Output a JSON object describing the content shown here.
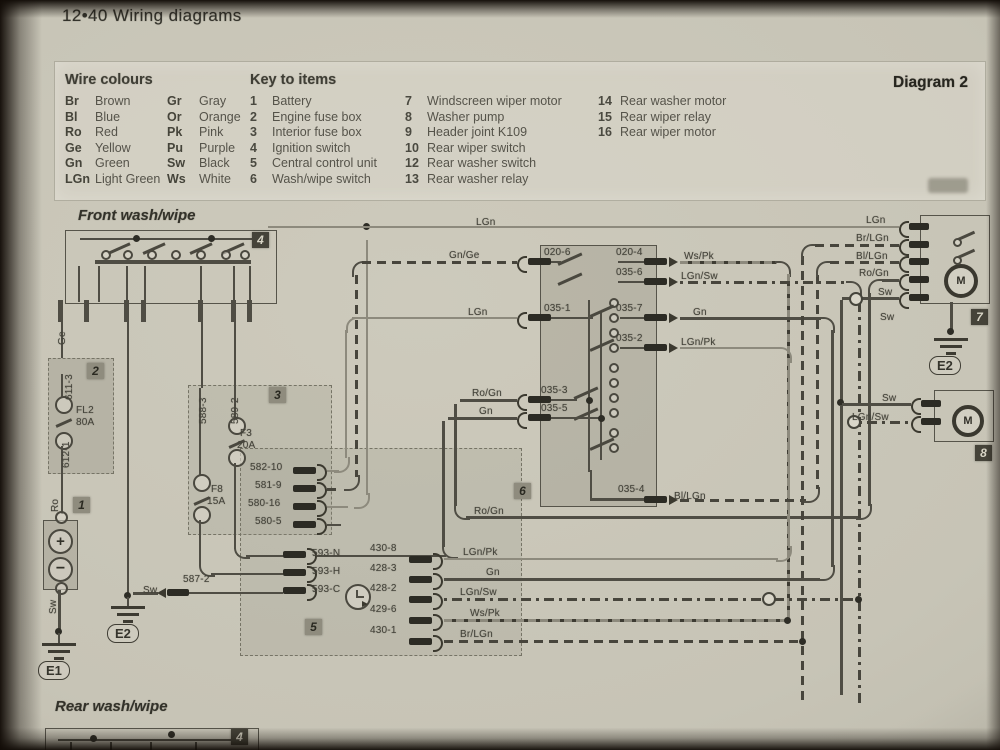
{
  "page": {
    "header": "12•40  Wiring diagrams",
    "diagram_label": "Diagram 2"
  },
  "legend": {
    "wire_colours_title": "Wire colours",
    "wire_colours": [
      {
        "code": "Br",
        "name": "Brown"
      },
      {
        "code": "Gr",
        "name": "Gray"
      },
      {
        "code": "Bl",
        "name": "Blue"
      },
      {
        "code": "Or",
        "name": "Orange"
      },
      {
        "code": "Ro",
        "name": "Red"
      },
      {
        "code": "Pk",
        "name": "Pink"
      },
      {
        "code": "Ge",
        "name": "Yellow"
      },
      {
        "code": "Pu",
        "name": "Purple"
      },
      {
        "code": "Gn",
        "name": "Green"
      },
      {
        "code": "Sw",
        "name": "Black"
      },
      {
        "code": "LGn",
        "name": "Light Green"
      },
      {
        "code": "Ws",
        "name": "White"
      }
    ],
    "key_title": "Key to items",
    "key_columns": [
      [
        {
          "num": "1",
          "label": "Battery"
        },
        {
          "num": "2",
          "label": "Engine fuse box"
        },
        {
          "num": "3",
          "label": "Interior fuse box"
        },
        {
          "num": "4",
          "label": "Ignition switch"
        },
        {
          "num": "5",
          "label": "Central control unit"
        },
        {
          "num": "6",
          "label": "Wash/wipe switch"
        }
      ],
      [
        {
          "num": "7",
          "label": "Windscreen wiper motor"
        },
        {
          "num": "8",
          "label": "Washer pump"
        },
        {
          "num": "9",
          "label": "Header joint K109"
        },
        {
          "num": "10",
          "label": "Rear wiper switch"
        },
        {
          "num": "12",
          "label": "Rear washer switch"
        },
        {
          "num": "13",
          "label": "Rear washer relay"
        }
      ],
      [
        {
          "num": "14",
          "label": "Rear washer motor"
        },
        {
          "num": "15",
          "label": "Rear wiper relay"
        },
        {
          "num": "16",
          "label": "Rear wiper motor"
        }
      ]
    ]
  },
  "front": {
    "title": "Front wash/wipe"
  },
  "rear": {
    "title": "Rear wash/wipe"
  },
  "component_tags": [
    {
      "t": "4",
      "x": 252,
      "y": 232,
      "dk": true
    },
    {
      "t": "2",
      "x": 87,
      "y": 363,
      "dk": false
    },
    {
      "t": "3",
      "x": 269,
      "y": 387,
      "dk": false
    },
    {
      "t": "1",
      "x": 73,
      "y": 497,
      "dk": false
    },
    {
      "t": "5",
      "x": 305,
      "y": 619,
      "dk": false
    },
    {
      "t": "6",
      "x": 514,
      "y": 483,
      "dk": false
    },
    {
      "t": "7",
      "x": 971,
      "y": 309,
      "dk": true
    },
    {
      "t": "8",
      "x": 975,
      "y": 445,
      "dk": true
    },
    {
      "t": "4",
      "x": 231,
      "y": 729,
      "dk": true
    }
  ],
  "grounds": [
    {
      "label": "E1",
      "cx": 59,
      "top": 643,
      "lx": 38,
      "ly": 661
    },
    {
      "label": "E2",
      "cx": 128,
      "top": 606,
      "lx": 107,
      "ly": 624
    },
    {
      "label": "E2",
      "cx": 951,
      "top": 338,
      "lx": 929,
      "ly": 356
    }
  ],
  "wire_labels": [
    {
      "t": "LGn",
      "x": 476,
      "y": 217
    },
    {
      "t": "Gn/Ge",
      "x": 449,
      "y": 250
    },
    {
      "t": "LGn",
      "x": 468,
      "y": 307
    },
    {
      "t": "Ro/Gn",
      "x": 472,
      "y": 388
    },
    {
      "t": "Gn",
      "x": 479,
      "y": 406
    },
    {
      "t": "Ro/Gn",
      "x": 474,
      "y": 506
    },
    {
      "t": "020-6",
      "x": 544,
      "y": 247
    },
    {
      "t": "020-4",
      "x": 616,
      "y": 247
    },
    {
      "t": "035-6",
      "x": 616,
      "y": 267
    },
    {
      "t": "035-1",
      "x": 544,
      "y": 303
    },
    {
      "t": "035-7",
      "x": 616,
      "y": 303
    },
    {
      "t": "035-2",
      "x": 616,
      "y": 333
    },
    {
      "t": "035-3",
      "x": 541,
      "y": 385
    },
    {
      "t": "035-5",
      "x": 541,
      "y": 403
    },
    {
      "t": "035-4",
      "x": 618,
      "y": 484
    },
    {
      "t": "Bl/LGn",
      "x": 674,
      "y": 491
    },
    {
      "t": "Ws/Pk",
      "x": 684,
      "y": 251
    },
    {
      "t": "LGn/Sw",
      "x": 681,
      "y": 271
    },
    {
      "t": "Gn",
      "x": 693,
      "y": 307
    },
    {
      "t": "LGn/Pk",
      "x": 681,
      "y": 337
    },
    {
      "t": "LGn",
      "x": 866,
      "y": 215
    },
    {
      "t": "Br/LGn",
      "x": 856,
      "y": 233
    },
    {
      "t": "Bl/LGn",
      "x": 856,
      "y": 251
    },
    {
      "t": "Ro/Gn",
      "x": 859,
      "y": 268
    },
    {
      "t": "Sw",
      "x": 878,
      "y": 287
    },
    {
      "t": "Sw",
      "x": 880,
      "y": 312
    },
    {
      "t": "Sw",
      "x": 882,
      "y": 393
    },
    {
      "t": "LGn/Sw",
      "x": 852,
      "y": 412
    },
    {
      "t": "582-10",
      "x": 250,
      "y": 462
    },
    {
      "t": "581-9",
      "x": 255,
      "y": 480
    },
    {
      "t": "580-16",
      "x": 248,
      "y": 498
    },
    {
      "t": "580-5",
      "x": 255,
      "y": 516
    },
    {
      "t": "593-N",
      "x": 312,
      "y": 548
    },
    {
      "t": "593-H",
      "x": 312,
      "y": 566
    },
    {
      "t": "593-C",
      "x": 312,
      "y": 584
    },
    {
      "t": "587-2",
      "x": 183,
      "y": 574
    },
    {
      "t": "Sw",
      "x": 143,
      "y": 585
    },
    {
      "t": "430-8",
      "x": 370,
      "y": 543
    },
    {
      "t": "428-3",
      "x": 370,
      "y": 563
    },
    {
      "t": "428-2",
      "x": 370,
      "y": 583
    },
    {
      "t": "429-6",
      "x": 370,
      "y": 604
    },
    {
      "t": "430-1",
      "x": 370,
      "y": 625
    },
    {
      "t": "LGn/Pk",
      "x": 463,
      "y": 547
    },
    {
      "t": "Gn",
      "x": 486,
      "y": 567
    },
    {
      "t": "LGn/Sw",
      "x": 460,
      "y": 587
    },
    {
      "t": "Ws/Pk",
      "x": 470,
      "y": 608
    },
    {
      "t": "Br/LGn",
      "x": 460,
      "y": 629
    },
    {
      "t": "F3",
      "x": 240,
      "y": 428
    },
    {
      "t": "20A",
      "x": 237,
      "y": 440
    },
    {
      "t": "F8",
      "x": 211,
      "y": 484
    },
    {
      "t": "15A",
      "x": 207,
      "y": 496
    },
    {
      "t": "FL2",
      "x": 76,
      "y": 405
    },
    {
      "t": "80A",
      "x": 76,
      "y": 417
    },
    {
      "t": "Ro",
      "x": 50,
      "y": 512,
      "v": true
    },
    {
      "t": "Sw",
      "x": 48,
      "y": 614,
      "v": true
    },
    {
      "t": "Ge",
      "x": 57,
      "y": 345,
      "v": true
    },
    {
      "t": "611-3",
      "x": 64,
      "y": 400,
      "v": true
    },
    {
      "t": "612-1",
      "x": 61,
      "y": 468,
      "v": true
    },
    {
      "t": "588-3",
      "x": 198,
      "y": 424,
      "v": true
    },
    {
      "t": "589-2",
      "x": 230,
      "y": 424,
      "v": true
    }
  ]
}
